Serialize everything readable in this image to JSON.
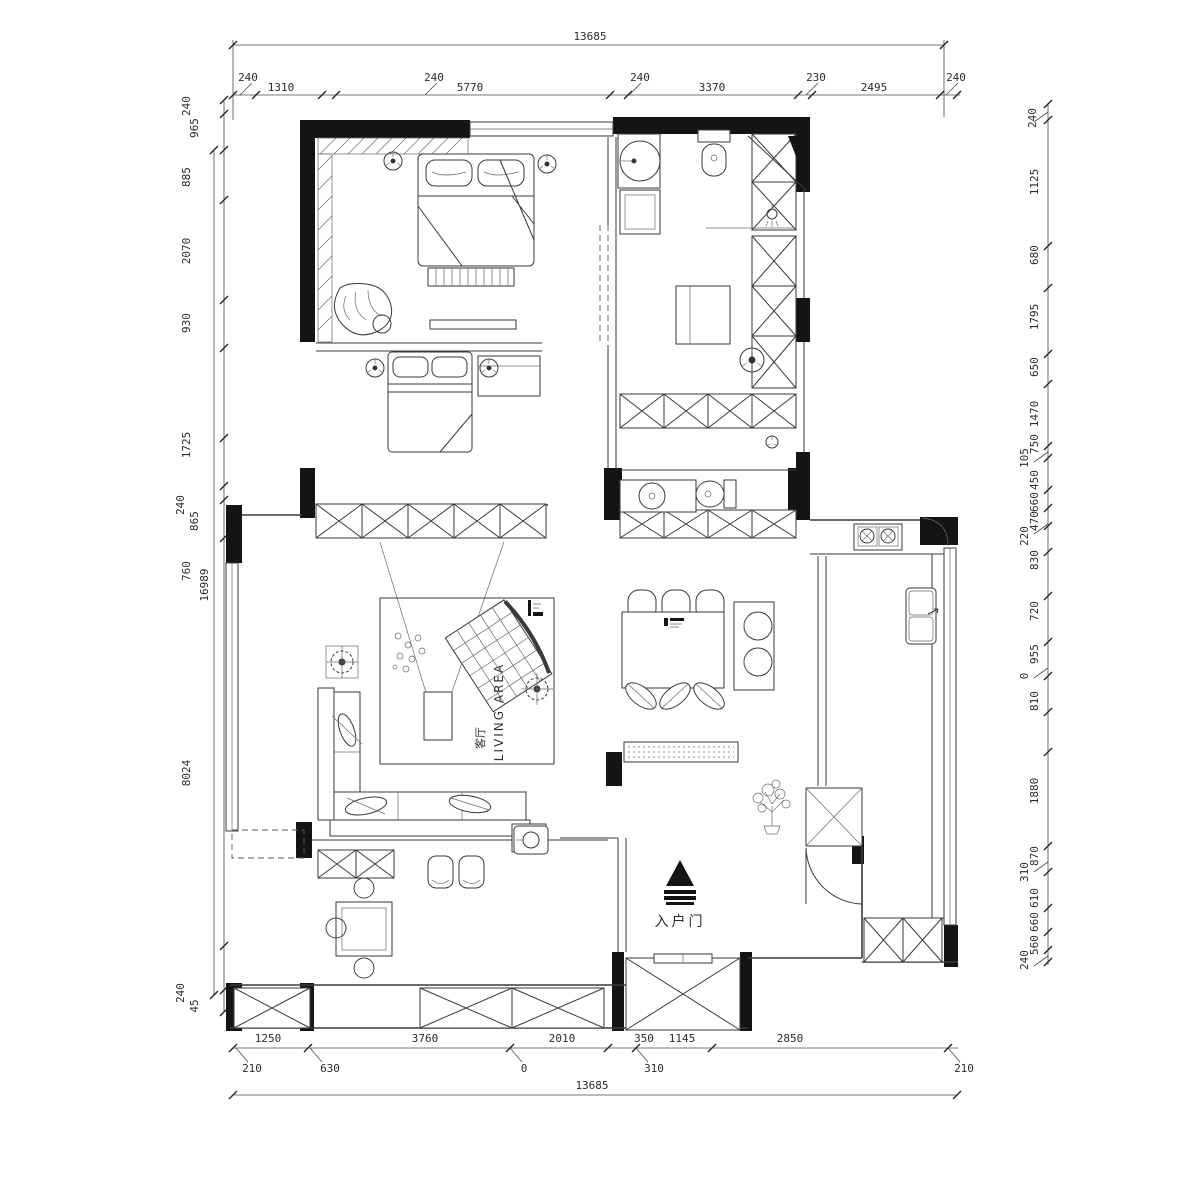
{
  "drawing": {
    "kind": "residential floor plan (CAD)",
    "ink_color": "#141414",
    "line_color": "#3a3a3a",
    "labels": {
      "living_area_en": "LIVING AREA",
      "living_area_cn": "客厅",
      "entry_door": "入户门"
    }
  },
  "dims": {
    "top_total": "13685",
    "top": [
      "240",
      "1310",
      "240",
      "5770",
      "240",
      "3370",
      "230",
      "2495",
      "240"
    ],
    "left": [
      "240",
      "965",
      "885",
      "2070",
      "930",
      "1725",
      "865",
      "240",
      "760",
      "8024",
      "240",
      "45"
    ],
    "left_total": "16989",
    "right": [
      "240",
      "1125",
      "680",
      "1795",
      "650",
      "1470",
      "750",
      "105",
      "450",
      "660",
      "470",
      "220",
      "830",
      "720",
      "955",
      "0",
      "810",
      "1880",
      "870",
      "310",
      "610",
      "660",
      "560",
      "240"
    ],
    "bottom": [
      "1250",
      "3760",
      "2010",
      "350",
      "1145",
      "2850"
    ],
    "bottom_leaders": [
      "210",
      "630",
      "0",
      "310",
      "210"
    ],
    "bottom_total": "13685"
  }
}
